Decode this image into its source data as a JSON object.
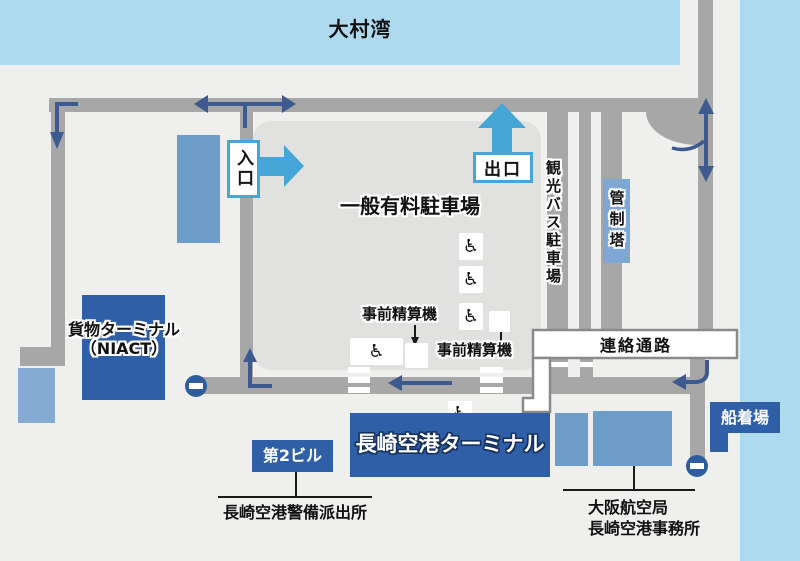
{
  "labels": {
    "bay": "大村湾",
    "parking": "一般有料駐車場",
    "entrance": "入口",
    "exit": "出口",
    "bus_parking": "観光バス駐車場",
    "control_tower": "管制塔",
    "cargo_line1": "貨物ターミナル",
    "cargo_line2": "（NIACT）",
    "payment_machine_1": "事前精算機",
    "payment_machine_2": "事前精算機",
    "walkway": "連絡通路",
    "terminal": "長崎空港ターミナル",
    "building2": "第2ビル",
    "police": "長崎空港警備派出所",
    "dock": "船着場",
    "office_line1": "大阪航空局",
    "office_line2": "長崎空港事務所"
  },
  "icons": {
    "wheelchair": "♿"
  },
  "colors": {
    "background": "#eff0ee",
    "water": "#aedaf0",
    "road": "#a7a7a7",
    "parking_area": "#e1e2e0",
    "navy": "#2f5fa7",
    "building_blue": "#6f9dca",
    "small_building_blue": "#85abd4",
    "tower_blue": "#7ea8d3",
    "accent_blue": "#46a6d8",
    "arrow_navy": "#3c5a90",
    "no_entry": "#2e5d9e"
  }
}
